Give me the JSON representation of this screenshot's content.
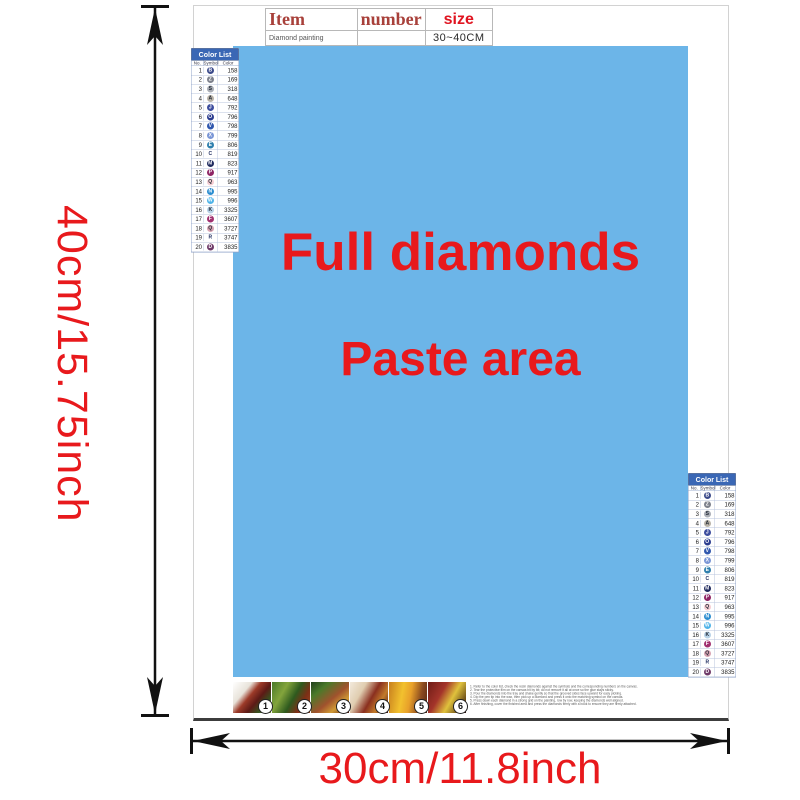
{
  "dimensions": {
    "height_label": "40cm/15.75inch",
    "width_label": "30cm/11.8inch",
    "label_color": "#e8191c"
  },
  "item_table": {
    "headers": [
      "Item",
      "number",
      "size"
    ],
    "row": {
      "item": "Diamond painting",
      "number": "",
      "size": "30~40CM"
    }
  },
  "paste_area": {
    "line1": "Full diamonds",
    "line2": "Paste area",
    "bg": "#6cb5e8",
    "text_color": "#e8191c"
  },
  "color_list": {
    "title": "Color List",
    "columns": [
      "No.",
      "Symbol",
      "Color"
    ],
    "header_bg": "#3a67b5",
    "rows": [
      {
        "no": "1",
        "sym": "B",
        "hex": "#3b4a8a",
        "code": "158"
      },
      {
        "no": "2",
        "sym": "Z",
        "hex": "#7d818c",
        "code": "169"
      },
      {
        "no": "3",
        "sym": "S",
        "hex": "#a9adb5",
        "code": "318"
      },
      {
        "no": "4",
        "sym": "A",
        "hex": "#b9b3a8",
        "code": "648"
      },
      {
        "no": "5",
        "sym": "J",
        "hex": "#3d4d9e",
        "code": "792"
      },
      {
        "no": "6",
        "sym": "O",
        "hex": "#2b3c8f",
        "code": "796"
      },
      {
        "no": "7",
        "sym": "V",
        "hex": "#3057ae",
        "code": "798"
      },
      {
        "no": "8",
        "sym": "X",
        "hex": "#7a96d6",
        "code": "799"
      },
      {
        "no": "9",
        "sym": "E",
        "hex": "#2e7fae",
        "code": "806"
      },
      {
        "no": "10",
        "sym": "C",
        "hex": "",
        "code": "819"
      },
      {
        "no": "11",
        "sym": "M",
        "hex": "#1f2a5e",
        "code": "823"
      },
      {
        "no": "12",
        "sym": "P",
        "hex": "#8e2464",
        "code": "917"
      },
      {
        "no": "13",
        "sym": "Q",
        "hex": "#f5cdd3",
        "code": "963"
      },
      {
        "no": "14",
        "sym": "N",
        "hex": "#2a8cd0",
        "code": "995"
      },
      {
        "no": "15",
        "sym": "W",
        "hex": "#4fb3e8",
        "code": "996"
      },
      {
        "no": "16",
        "sym": "K",
        "hex": "#b8d2e8",
        "code": "3325"
      },
      {
        "no": "17",
        "sym": "F",
        "hex": "#a13070",
        "code": "3607"
      },
      {
        "no": "18",
        "sym": "Q",
        "hex": "#d8a3b2",
        "code": "3727"
      },
      {
        "no": "19",
        "sym": "R",
        "hex": "",
        "code": "3747"
      },
      {
        "no": "20",
        "sym": "D",
        "hex": "#6e3a68",
        "code": "3835"
      }
    ]
  },
  "steps": [
    {
      "n": "1",
      "photo": "linear-gradient(130deg,#ffffff 0%,#e8e3da 30%,#9c3a28 45%,#5c1a16 62%,#35551f 80%,#7a9c3a 100%)"
    },
    {
      "n": "2",
      "photo": "linear-gradient(120deg,#4a7a2a 0%,#83a43c 30%,#2e5a1e 55%,#7c2f16 75%,#a44a20 100%)"
    },
    {
      "n": "3",
      "photo": "linear-gradient(140deg,#22401d 0%,#4a7a2a 25%,#a0522d 55%,#d09a35 75%,#5c1f14 100%)"
    },
    {
      "n": "4",
      "photo": "linear-gradient(120deg,#f2e9dc 0%,#e0cdb0 30%,#8a2f1f 55%,#c27b2a 75%,#471313 100%)"
    },
    {
      "n": "5",
      "photo": "linear-gradient(100deg,#c87f1e 0%,#f2c12e 35%,#e8a02a 55%,#8a4a1f 80%,#5c2a14 100%)"
    },
    {
      "n": "6",
      "photo": "linear-gradient(120deg,#6e1c16 0%,#a4342a 35%,#e0c23c 60%,#7a5c1e 82%,#2e0d0d 100%)"
    }
  ],
  "instructions": {
    "lines": [
      {
        "t": "1. Refer to the color list, check the resin diamonds against the symbols and the corresponding numbers on the canvas."
      },
      {
        "t": "2. Tear the protective film on the canvas bit by bit; do not remove it all at once so the glue stays sticky."
      },
      {
        "t": "3. Pour the diamonds into the tray and shake gently so that the grooved sides face upward for easy picking."
      },
      {
        "t": "4. Dip the pen tip into the wax, then pick up a diamond and press it onto the matching symbol on the canvas."
      },
      {
        "t": "5. Press down each diamond in a strong grid on the painting, row by row, keeping the diamonds well aligned."
      },
      {
        "t": "6. After finishing, cover the finished area and press the diamonds firmly with a book to ensure they are firmly attached."
      }
    ]
  }
}
